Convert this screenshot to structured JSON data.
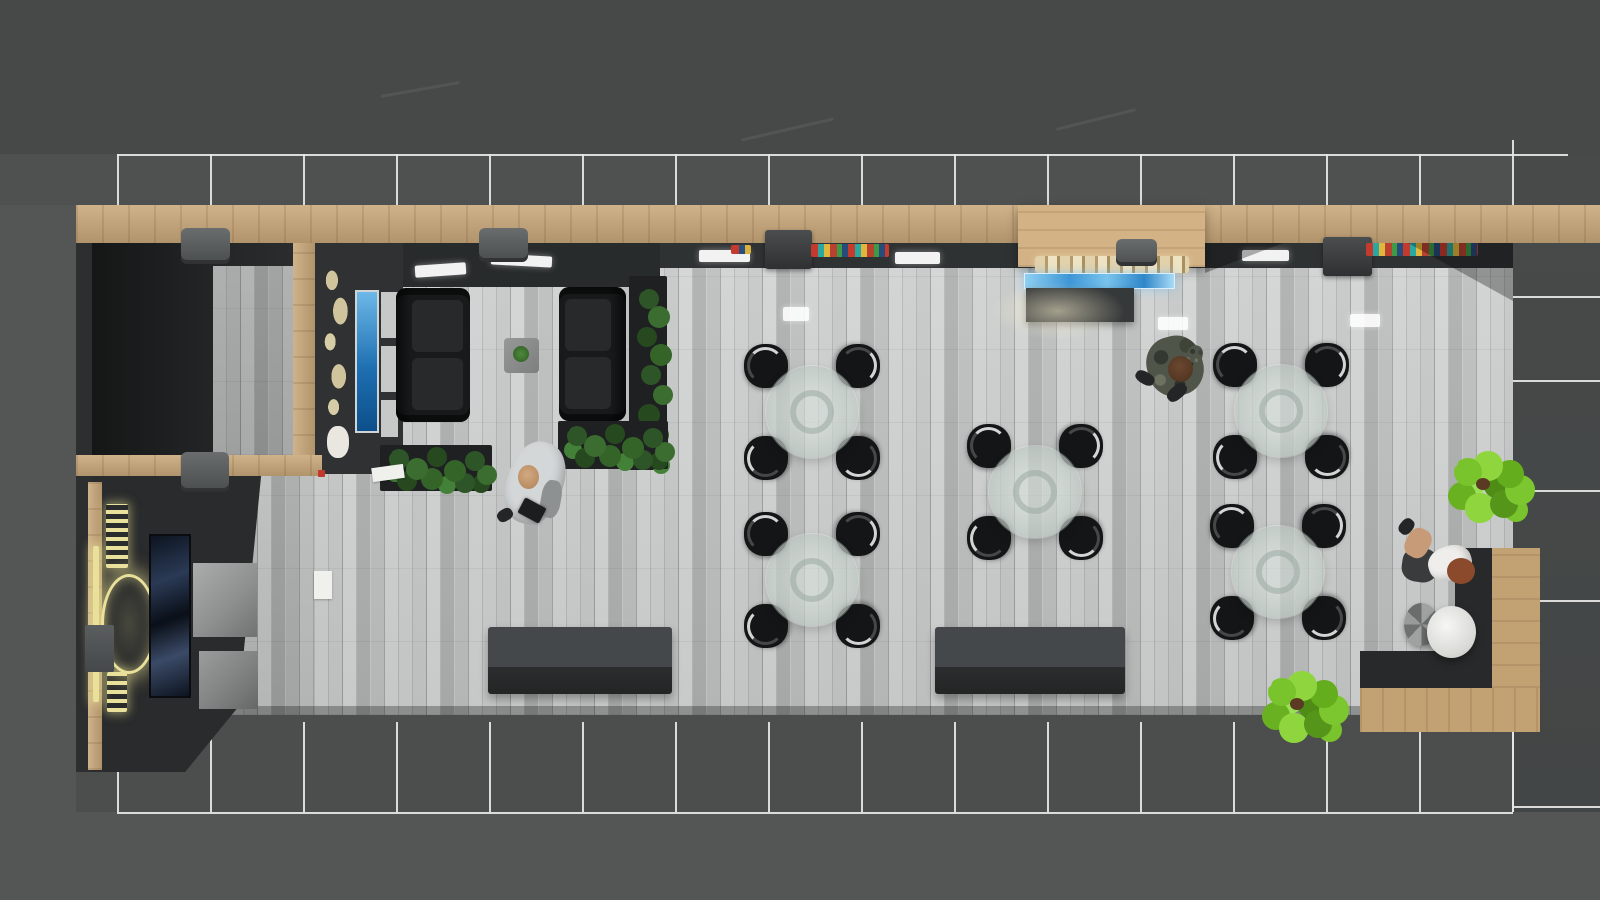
{
  "scene": {
    "description": "top-down 3d architectural render of a cafe lounge interior",
    "canvas": {
      "width": 1600,
      "height": 900
    }
  },
  "palette": {
    "ground": "#535655",
    "ground_top": "#464948",
    "glass_frame": "#e7e7e5",
    "wood": "#c9a87a",
    "wall_dark": "#2c2e2f",
    "floor_plank": "#bfc2c1",
    "tile_dark": "#454848",
    "chair_black": "#141516",
    "glass_table": "#c4cec9",
    "logo_gold": "#e9e19b",
    "tv_blue": "#1e6fb2",
    "display_blue": "#3e96d6",
    "plant_dark": "#356428",
    "plant_lime": "#79c32c",
    "pouf_white": "#ececea",
    "merch_red": "#c43b2e",
    "merch_teal": "#2aa7a0",
    "merch_yellow": "#e0b63c"
  },
  "people": [
    {
      "label": "man in white shirt walking with tablet",
      "x": 535,
      "y": 483
    },
    {
      "label": "person in camouflage standing near counter",
      "x": 1172,
      "y": 365
    },
    {
      "label": "woman seated at corner bench",
      "x": 1437,
      "y": 552
    }
  ],
  "glass": {
    "cols": [
      117,
      210,
      303,
      396,
      489,
      582,
      675,
      768,
      861,
      954,
      1047,
      1140,
      1233,
      1326,
      1419,
      1512
    ],
    "top": {
      "y": 154,
      "x1": 117,
      "x2": 1568,
      "stub_y2": 205
    },
    "bottom": {
      "y": 812,
      "x1": 117,
      "x2": 1513,
      "stub_y1": 722
    },
    "right": {
      "x1": 1513,
      "x2": 1600,
      "hlines": [
        296,
        380,
        490,
        600,
        806
      ],
      "vsegs": [
        [
          1512,
          140,
          154
        ],
        [
          1512,
          722,
          812
        ]
      ]
    }
  },
  "tables": {
    "count": 5,
    "centers": [
      [
        812,
        412
      ],
      [
        812,
        580
      ],
      [
        1035,
        492
      ],
      [
        1281,
        411
      ],
      [
        1278,
        572
      ]
    ],
    "radius": 46,
    "chair_size": 44,
    "chair_offset": 46,
    "chairs_per_table": 4
  },
  "base": [
    {
      "n": "exterior-top-band",
      "c": "band-a",
      "x": 0,
      "y": 0,
      "w": 1600,
      "h": 154
    },
    {
      "n": "glass-walkway-band",
      "c": "band-b",
      "x": 0,
      "y": 154,
      "w": 1600,
      "h": 51
    },
    {
      "n": "right-tile-floor",
      "c": "tiles",
      "x": 1513,
      "y": 154,
      "w": 87,
      "h": 658
    },
    {
      "n": "bottom-pavement",
      "c": "pavement",
      "x": 76,
      "y": 712,
      "w": 1437,
      "h": 100
    },
    {
      "n": "roof-streak",
      "c": "streak",
      "x": 380,
      "y": 88,
      "w": 80,
      "h": 3,
      "rot": -10
    },
    {
      "n": "roof-streak",
      "c": "streak",
      "x": 740,
      "y": 128,
      "w": 95,
      "h": 3,
      "rot": -13
    },
    {
      "n": "roof-streak",
      "c": "streak",
      "x": 1055,
      "y": 118,
      "w": 82,
      "h": 3,
      "rot": -14
    }
  ],
  "shapes": [
    {
      "n": "left-wall",
      "c": "wall-dark",
      "x": 76,
      "y": 205,
      "w": 18,
      "h": 567
    },
    {
      "n": "top-wood-beam",
      "c": "wood-h",
      "x": 76,
      "y": 205,
      "w": 1524,
      "h": 38
    },
    {
      "n": "soffit-band",
      "c": "soffit",
      "x": 315,
      "y": 243,
      "w": 1198,
      "h": 26
    },
    {
      "n": "main-floor",
      "c": "floor",
      "x": 315,
      "y": 268,
      "w": 1198,
      "h": 447
    },
    {
      "n": "corridor-floor",
      "c": "floor dim2",
      "x": 230,
      "y": 476,
      "w": 85,
      "h": 239
    },
    {
      "n": "floor-edge-shadow",
      "c": "edge-dark",
      "x": 230,
      "y": 706,
      "w": 1283,
      "h": 9
    },
    {
      "n": "entry-alcove-room",
      "c": "room-dark",
      "x": 92,
      "y": 243,
      "w": 210,
      "h": 216
    },
    {
      "n": "alcove-floor",
      "c": "floor dim",
      "x": 213,
      "y": 266,
      "w": 89,
      "h": 189
    },
    {
      "n": "wood-divider",
      "c": "wood-v",
      "x": 293,
      "y": 243,
      "w": 22,
      "h": 219
    },
    {
      "n": "lounge-back-wall",
      "c": "wall-dark2",
      "x": 315,
      "y": 243,
      "w": 88,
      "h": 231
    },
    {
      "n": "lounge-soffit",
      "c": "soffit2",
      "x": 403,
      "y": 243,
      "w": 257,
      "h": 44
    },
    {
      "n": "mid-wood-beam",
      "c": "wood-h",
      "x": 76,
      "y": 455,
      "w": 246,
      "h": 21
    },
    {
      "n": "extinguisher-dot",
      "c": "dot-red",
      "x": 318,
      "y": 470,
      "w": 7,
      "h": 7
    },
    {
      "n": "logo-room",
      "c": "room-dark2",
      "x": 92,
      "y": 476,
      "w": 190,
      "h": 296,
      "clip": "polygon(0 0,89% 0,77% 78%,49% 100%,0 100%)"
    },
    {
      "n": "left-wood-strip",
      "c": "wood-v",
      "x": 88,
      "y": 482,
      "w": 14,
      "h": 288
    },
    {
      "n": "logo-crest-ring",
      "c": "logo-ring",
      "x": 101,
      "y": 574,
      "w": 56,
      "h": 100
    },
    {
      "n": "logo-text-top",
      "c": "logo-text",
      "x": 106,
      "y": 504,
      "w": 22,
      "h": 64
    },
    {
      "n": "logo-text-bottom",
      "c": "logo-text",
      "x": 107,
      "y": 672,
      "w": 20,
      "h": 40
    },
    {
      "n": "logo-side-bar",
      "c": "logo-bar",
      "x": 93,
      "y": 546,
      "w": 6,
      "h": 156
    },
    {
      "n": "framed-picture",
      "c": "picture",
      "x": 149,
      "y": 534,
      "w": 42,
      "h": 164
    },
    {
      "n": "storage-cube",
      "c": "cube1",
      "x": 199,
      "y": 487,
      "w": 58,
      "h": 59
    },
    {
      "n": "storage-cube",
      "c": "cube2",
      "x": 193,
      "y": 563,
      "w": 64,
      "h": 74
    },
    {
      "n": "storage-cube",
      "c": "cube3",
      "x": 199,
      "y": 651,
      "w": 59,
      "h": 58
    },
    {
      "n": "wall-kiosk-box",
      "c": "wall-box",
      "x": 85,
      "y": 625,
      "w": 29,
      "h": 47
    },
    {
      "n": "world-map-art",
      "c": "map-art",
      "x": 320,
      "y": 265,
      "w": 34,
      "h": 192
    },
    {
      "n": "map-art-fragment",
      "c": "map-white",
      "x": 327,
      "y": 426,
      "w": 22,
      "h": 32
    },
    {
      "n": "tv-screen",
      "c": "tv",
      "x": 355,
      "y": 290,
      "w": 24,
      "h": 143
    },
    {
      "n": "wall-panel",
      "c": "panel",
      "x": 381,
      "y": 292,
      "w": 17,
      "h": 46
    },
    {
      "n": "wall-panel",
      "c": "panel",
      "x": 381,
      "y": 346,
      "w": 17,
      "h": 46
    },
    {
      "n": "wall-panel",
      "c": "panel",
      "x": 381,
      "y": 400,
      "w": 17,
      "h": 37
    },
    {
      "n": "sofa",
      "c": "sofa",
      "x": 396,
      "y": 288,
      "w": 74,
      "h": 134
    },
    {
      "n": "sofa",
      "c": "sofa sofa-flip",
      "x": 559,
      "y": 287,
      "w": 67,
      "h": 134
    },
    {
      "n": "coffee-table",
      "c": "ctable",
      "x": 504,
      "y": 338,
      "w": 35,
      "h": 35
    },
    {
      "n": "table-plant",
      "c": "plant-mini",
      "x": 513,
      "y": 346,
      "w": 16,
      "h": 16
    },
    {
      "n": "planter-box",
      "c": "planter",
      "x": 380,
      "y": 445,
      "w": 112,
      "h": 46
    },
    {
      "n": "planter-leaves",
      "c": "leaves-h",
      "x": 382,
      "y": 446,
      "w": 10,
      "h": 10
    },
    {
      "n": "planter-box",
      "c": "planter",
      "x": 629,
      "y": 276,
      "w": 38,
      "h": 194
    },
    {
      "n": "planter-leaves",
      "c": "leaves-v",
      "x": 636,
      "y": 282,
      "w": 10,
      "h": 10
    },
    {
      "n": "planter-box",
      "c": "planter",
      "x": 558,
      "y": 421,
      "w": 110,
      "h": 48
    },
    {
      "n": "planter-leaves",
      "c": "leaves-h",
      "x": 560,
      "y": 423,
      "w": 10,
      "h": 10
    },
    {
      "n": "paper-sheet",
      "c": "paper",
      "x": 372,
      "y": 466,
      "w": 32,
      "h": 14,
      "rot": -8
    },
    {
      "n": "paper-sheet",
      "c": "paper",
      "x": 314,
      "y": 571,
      "w": 18,
      "h": 28
    },
    {
      "n": "service-counter",
      "c": "counter",
      "x": 488,
      "y": 627,
      "w": 184,
      "h": 67
    },
    {
      "n": "service-counter",
      "c": "counter",
      "x": 935,
      "y": 627,
      "w": 190,
      "h": 67
    },
    {
      "n": "food-canopy",
      "c": "wood-canopy",
      "x": 1018,
      "y": 205,
      "w": 187,
      "h": 62
    },
    {
      "n": "bread-display",
      "c": "bread",
      "x": 1035,
      "y": 256,
      "w": 154,
      "h": 17
    },
    {
      "n": "blue-display-case",
      "c": "bluebar",
      "x": 1024,
      "y": 273,
      "w": 151,
      "h": 16
    },
    {
      "n": "food-counter",
      "c": "counter-dark",
      "x": 1026,
      "y": 288,
      "w": 108,
      "h": 34
    },
    {
      "n": "counter-glow",
      "c": "glow",
      "x": 990,
      "y": 282,
      "w": 135,
      "h": 58
    },
    {
      "n": "ceiling-light",
      "c": "slight",
      "x": 415,
      "y": 264,
      "w": 51,
      "h": 12,
      "rot": -4
    },
    {
      "n": "ceiling-light",
      "c": "slight",
      "x": 491,
      "y": 255,
      "w": 61,
      "h": 11,
      "rot": 3
    },
    {
      "n": "ceiling-light",
      "c": "slight",
      "x": 699,
      "y": 250,
      "w": 51,
      "h": 12
    },
    {
      "n": "ceiling-light",
      "c": "slight",
      "x": 895,
      "y": 252,
      "w": 45,
      "h": 12
    },
    {
      "n": "ceiling-light",
      "c": "slight",
      "x": 1242,
      "y": 250,
      "w": 47,
      "h": 11
    },
    {
      "n": "spotlight-fixture",
      "c": "fixture",
      "x": 181,
      "y": 228,
      "w": 49,
      "h": 36
    },
    {
      "n": "spotlight-fixture",
      "c": "fixture",
      "x": 479,
      "y": 228,
      "w": 49,
      "h": 34
    },
    {
      "n": "spotlight-fixture",
      "c": "fixture",
      "x": 181,
      "y": 452,
      "w": 48,
      "h": 40
    },
    {
      "n": "spotlight-fixture",
      "c": "fixture",
      "x": 1116,
      "y": 239,
      "w": 41,
      "h": 27
    },
    {
      "n": "coffee-machine",
      "c": "machine",
      "x": 765,
      "y": 230,
      "w": 47,
      "h": 39
    },
    {
      "n": "coffee-machine",
      "c": "machine",
      "x": 1323,
      "y": 237,
      "w": 49,
      "h": 39
    },
    {
      "n": "merch-shelf",
      "c": "merch",
      "x": 811,
      "y": 244,
      "w": 78,
      "h": 13
    },
    {
      "n": "merch-shelf",
      "c": "merch",
      "x": 1366,
      "y": 243,
      "w": 112,
      "h": 13
    },
    {
      "n": "merch-shelf-small",
      "c": "merch-sm",
      "x": 731,
      "y": 245,
      "w": 20,
      "h": 9
    },
    {
      "n": "corner-shadow",
      "c": "shade",
      "x": 1408,
      "y": 243,
      "w": 105,
      "h": 58,
      "clip": "polygon(0 0,100% 0,100% 100%)"
    },
    {
      "n": "canopy-shadow",
      "c": "shade",
      "x": 1205,
      "y": 243,
      "w": 78,
      "h": 30,
      "clip": "polygon(0 0,100% 0,0 100%)"
    },
    {
      "n": "floor-light-reflection",
      "c": "floor-light",
      "x": 783,
      "y": 307,
      "w": 26,
      "h": 14
    },
    {
      "n": "floor-light-reflection",
      "c": "floor-light",
      "x": 1158,
      "y": 317,
      "w": 30,
      "h": 13
    },
    {
      "n": "floor-light-reflection",
      "c": "floor-light",
      "x": 1350,
      "y": 314,
      "w": 30,
      "h": 13
    },
    {
      "n": "bench-backrest",
      "c": "bench-dark",
      "x": 1455,
      "y": 548,
      "w": 37,
      "h": 140
    },
    {
      "n": "bench-backrest",
      "c": "bench-dark",
      "x": 1360,
      "y": 651,
      "w": 132,
      "h": 37
    },
    {
      "n": "bench-wood-seat",
      "c": "wood-v2",
      "x": 1492,
      "y": 548,
      "w": 48,
      "h": 184
    },
    {
      "n": "bench-wood-seat",
      "c": "wood-h2",
      "x": 1360,
      "y": 688,
      "w": 180,
      "h": 44
    },
    {
      "n": "side-stool",
      "c": "stool",
      "x": 1404,
      "y": 603,
      "w": 35,
      "h": 43
    },
    {
      "n": "white-pouf",
      "c": "pouf",
      "x": 1427,
      "y": 606,
      "w": 49,
      "h": 52
    },
    {
      "n": "potted-plant",
      "c": "monstera",
      "x": 1446,
      "y": 456,
      "w": 12,
      "h": 12
    },
    {
      "n": "potted-plant",
      "c": "monstera",
      "x": 1260,
      "y": 676,
      "w": 12,
      "h": 12
    },
    {
      "n": "man-body",
      "c": "p-body-light",
      "x": 507,
      "y": 441,
      "w": 56,
      "h": 84,
      "rot": 18
    },
    {
      "n": "man-trouser-leg",
      "c": "p-leg-gray",
      "x": 541,
      "y": 480,
      "w": 20,
      "h": 38,
      "rot": 10
    },
    {
      "n": "man-head",
      "c": "p-head",
      "x": 518,
      "y": 465,
      "w": 21,
      "h": 24
    },
    {
      "n": "man-tablet",
      "c": "p-tablet",
      "x": 520,
      "y": 502,
      "w": 24,
      "h": 17,
      "rot": 28
    },
    {
      "n": "man-shoe",
      "c": "p-shoe",
      "x": 497,
      "y": 509,
      "w": 16,
      "h": 12,
      "rot": -30
    },
    {
      "n": "camo-person-body",
      "c": "p-body-camo",
      "x": 1147,
      "y": 336,
      "w": 56,
      "h": 60,
      "rot": -15
    },
    {
      "n": "camo-person-arm",
      "c": "p-body-camo",
      "x": 1186,
      "y": 345,
      "w": 16,
      "h": 24,
      "rot": 20
    },
    {
      "n": "camo-person-head",
      "c": "p-head-brown",
      "x": 1168,
      "y": 356,
      "w": 25,
      "h": 26
    },
    {
      "n": "camo-person-boot",
      "c": "p-shoe",
      "x": 1135,
      "y": 372,
      "w": 20,
      "h": 12,
      "rot": 30
    },
    {
      "n": "camo-person-boot",
      "c": "p-shoe",
      "x": 1166,
      "y": 386,
      "w": 22,
      "h": 13,
      "rot": -40
    },
    {
      "n": "woman-skirt",
      "c": "p-skirt",
      "x": 1402,
      "y": 548,
      "w": 36,
      "h": 34,
      "rot": 8
    },
    {
      "n": "woman-legs",
      "c": "p-legs",
      "x": 1406,
      "y": 528,
      "w": 24,
      "h": 30,
      "rot": 28
    },
    {
      "n": "woman-shoe",
      "c": "p-shoe",
      "x": 1400,
      "y": 518,
      "w": 13,
      "h": 17,
      "rot": 40
    },
    {
      "n": "woman-torso",
      "c": "p-body-white",
      "x": 1428,
      "y": 546,
      "w": 44,
      "h": 34,
      "rot": -18
    },
    {
      "n": "woman-hair",
      "c": "p-hair",
      "x": 1447,
      "y": 558,
      "w": 28,
      "h": 26
    }
  ]
}
